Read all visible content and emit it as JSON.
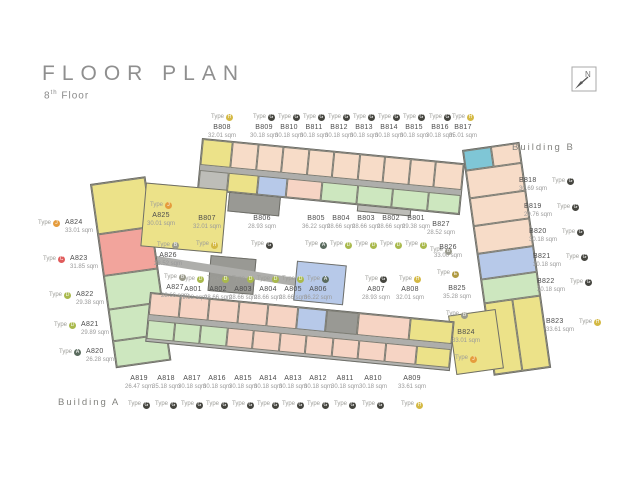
{
  "title": {
    "main": "FLOOR PLAN",
    "floor_number": "8",
    "floor_ordinal": "th",
    "floor_word": "Floor"
  },
  "compass": {
    "label": "N"
  },
  "building_a_label": "Building A",
  "building_b_label": "Building B",
  "labels": {
    "type_prefix": "Type",
    "sqm_suffix": "sqm"
  },
  "type_colors": {
    "A": "#5a6b5e",
    "B": "#9a9a8c",
    "C": "#e05b5b",
    "D": "#a9b94c",
    "E": "#b09a42",
    "G": "#45453f",
    "H": "#d4b944",
    "J": "#e59c3d"
  },
  "units": [
    {
      "id": "B808",
      "sqm": "32.01",
      "type": "H",
      "layout": "v-top",
      "x": 222,
      "y": 104
    },
    {
      "id": "B809",
      "sqm": "30.18",
      "type": "G",
      "layout": "v-top",
      "x": 264,
      "y": 104
    },
    {
      "id": "B810",
      "sqm": "30.18",
      "type": "G",
      "layout": "v-top",
      "x": 289,
      "y": 104
    },
    {
      "id": "B811",
      "sqm": "30.18",
      "type": "G",
      "layout": "v-top",
      "x": 314,
      "y": 104
    },
    {
      "id": "B812",
      "sqm": "30.18",
      "type": "G",
      "layout": "v-top",
      "x": 339,
      "y": 104
    },
    {
      "id": "B813",
      "sqm": "30.18",
      "type": "G",
      "layout": "v-top",
      "x": 364,
      "y": 104
    },
    {
      "id": "B814",
      "sqm": "30.18",
      "type": "G",
      "layout": "v-top",
      "x": 389,
      "y": 104
    },
    {
      "id": "B815",
      "sqm": "30.18",
      "type": "G",
      "layout": "v-top",
      "x": 414,
      "y": 104
    },
    {
      "id": "B816",
      "sqm": "30.18",
      "type": "G",
      "layout": "v-top",
      "x": 440,
      "y": 104
    },
    {
      "id": "B817",
      "sqm": "35.01",
      "type": "H",
      "layout": "v-top",
      "x": 463,
      "y": 104
    },
    {
      "id": "B807",
      "sqm": "32.01",
      "type": "H",
      "layout": "v-bottom",
      "x": 207,
      "y": 215
    },
    {
      "id": "B806",
      "sqm": "28.93",
      "type": "G",
      "layout": "v-bottom",
      "x": 262,
      "y": 215
    },
    {
      "id": "B805",
      "sqm": "36.22",
      "type": "A",
      "layout": "v-bottom",
      "x": 316,
      "y": 215
    },
    {
      "id": "B804",
      "sqm": "28.66",
      "type": "D",
      "layout": "v-bottom",
      "x": 341,
      "y": 215
    },
    {
      "id": "B803",
      "sqm": "28.66",
      "type": "D",
      "layout": "v-bottom",
      "x": 366,
      "y": 215
    },
    {
      "id": "B802",
      "sqm": "28.66",
      "type": "D",
      "layout": "v-bottom",
      "x": 391,
      "y": 215
    },
    {
      "id": "B801",
      "sqm": "29.38",
      "type": "D",
      "layout": "v-bottom",
      "x": 416,
      "y": 215
    },
    {
      "id": "B818",
      "sqm": "30.69",
      "type": "G",
      "layout": "h-right",
      "x": 519,
      "y": 177
    },
    {
      "id": "B819",
      "sqm": "29.76",
      "type": "G",
      "layout": "h-right",
      "x": 524,
      "y": 203
    },
    {
      "id": "B820",
      "sqm": "30.18",
      "type": "G",
      "layout": "h-right",
      "x": 529,
      "y": 228
    },
    {
      "id": "B821",
      "sqm": "30.18",
      "type": "G",
      "layout": "h-right",
      "x": 533,
      "y": 253
    },
    {
      "id": "B822",
      "sqm": "30.18",
      "type": "G",
      "layout": "h-right",
      "x": 537,
      "y": 278
    },
    {
      "id": "B823",
      "sqm": "33.61",
      "type": "H",
      "layout": "h-right",
      "x": 546,
      "y": 318
    },
    {
      "id": "B827",
      "sqm": "28.52",
      "type": "B",
      "layout": "v-bottom",
      "x": 441,
      "y": 221
    },
    {
      "id": "B826",
      "sqm": "33.00",
      "type": "E",
      "layout": "v-bottom",
      "x": 448,
      "y": 244
    },
    {
      "id": "B825",
      "sqm": "35.28",
      "type": "B",
      "layout": "v-bottom",
      "x": 457,
      "y": 285
    },
    {
      "id": "B824",
      "sqm": "33.01",
      "type": "J",
      "layout": "v-bottom",
      "x": 466,
      "y": 329
    },
    {
      "id": "A801",
      "sqm": "29.38",
      "type": "D",
      "layout": "v-top",
      "x": 193,
      "y": 266
    },
    {
      "id": "A802",
      "sqm": "28.66",
      "type": "D",
      "layout": "v-top",
      "x": 218,
      "y": 266
    },
    {
      "id": "A803",
      "sqm": "28.66",
      "type": "D",
      "layout": "v-top",
      "x": 243,
      "y": 266
    },
    {
      "id": "A804",
      "sqm": "28.66",
      "type": "D",
      "layout": "v-top",
      "x": 268,
      "y": 266
    },
    {
      "id": "A805",
      "sqm": "28.66",
      "type": "D",
      "layout": "v-top",
      "x": 293,
      "y": 266
    },
    {
      "id": "A806",
      "sqm": "36.22",
      "type": "A",
      "layout": "v-top",
      "x": 318,
      "y": 266
    },
    {
      "id": "A807",
      "sqm": "28.93",
      "type": "G",
      "layout": "v-top",
      "x": 376,
      "y": 266
    },
    {
      "id": "A808",
      "sqm": "32.01",
      "type": "H",
      "layout": "v-top",
      "x": 410,
      "y": 266
    },
    {
      "id": "A819",
      "sqm": "26.47",
      "type": "G",
      "layout": "v-bottom",
      "x": 139,
      "y": 375
    },
    {
      "id": "A818",
      "sqm": "35.18",
      "type": "G",
      "layout": "v-bottom",
      "x": 166,
      "y": 375
    },
    {
      "id": "A817",
      "sqm": "30.18",
      "type": "G",
      "layout": "v-bottom",
      "x": 192,
      "y": 375
    },
    {
      "id": "A816",
      "sqm": "30.18",
      "type": "G",
      "layout": "v-bottom",
      "x": 217,
      "y": 375
    },
    {
      "id": "A815",
      "sqm": "30.18",
      "type": "G",
      "layout": "v-bottom",
      "x": 243,
      "y": 375
    },
    {
      "id": "A814",
      "sqm": "30.18",
      "type": "G",
      "layout": "v-bottom",
      "x": 268,
      "y": 375
    },
    {
      "id": "A813",
      "sqm": "30.18",
      "type": "G",
      "layout": "v-bottom",
      "x": 293,
      "y": 375
    },
    {
      "id": "A812",
      "sqm": "30.18",
      "type": "G",
      "layout": "v-bottom",
      "x": 318,
      "y": 375
    },
    {
      "id": "A811",
      "sqm": "30.18",
      "type": "G",
      "layout": "v-bottom",
      "x": 345,
      "y": 375
    },
    {
      "id": "A810",
      "sqm": "30.18",
      "type": "G",
      "layout": "v-bottom",
      "x": 373,
      "y": 375
    },
    {
      "id": "A809",
      "sqm": "33.61",
      "type": "H",
      "layout": "v-bottom",
      "x": 412,
      "y": 375
    },
    {
      "id": "A824",
      "sqm": "33.01",
      "type": "J",
      "layout": "h-left",
      "x": 38,
      "y": 219
    },
    {
      "id": "A823",
      "sqm": "31.85",
      "type": "C",
      "layout": "h-left",
      "x": 43,
      "y": 255
    },
    {
      "id": "A822",
      "sqm": "29.38",
      "type": "D",
      "layout": "h-left",
      "x": 49,
      "y": 291
    },
    {
      "id": "A821",
      "sqm": "29.89",
      "type": "D",
      "layout": "h-left",
      "x": 54,
      "y": 321
    },
    {
      "id": "A820",
      "sqm": "26.28",
      "type": "A",
      "layout": "h-left",
      "x": 59,
      "y": 348
    },
    {
      "id": "A825",
      "sqm": "30.01",
      "type": "J",
      "layout": "v-top",
      "x": 161,
      "y": 192
    },
    {
      "id": "A826",
      "sqm": "28.52",
      "type": "B",
      "layout": "v-top",
      "x": 168,
      "y": 232
    },
    {
      "id": "A827",
      "sqm": "28.66",
      "type": "B",
      "layout": "v-top",
      "x": 175,
      "y": 264
    }
  ]
}
